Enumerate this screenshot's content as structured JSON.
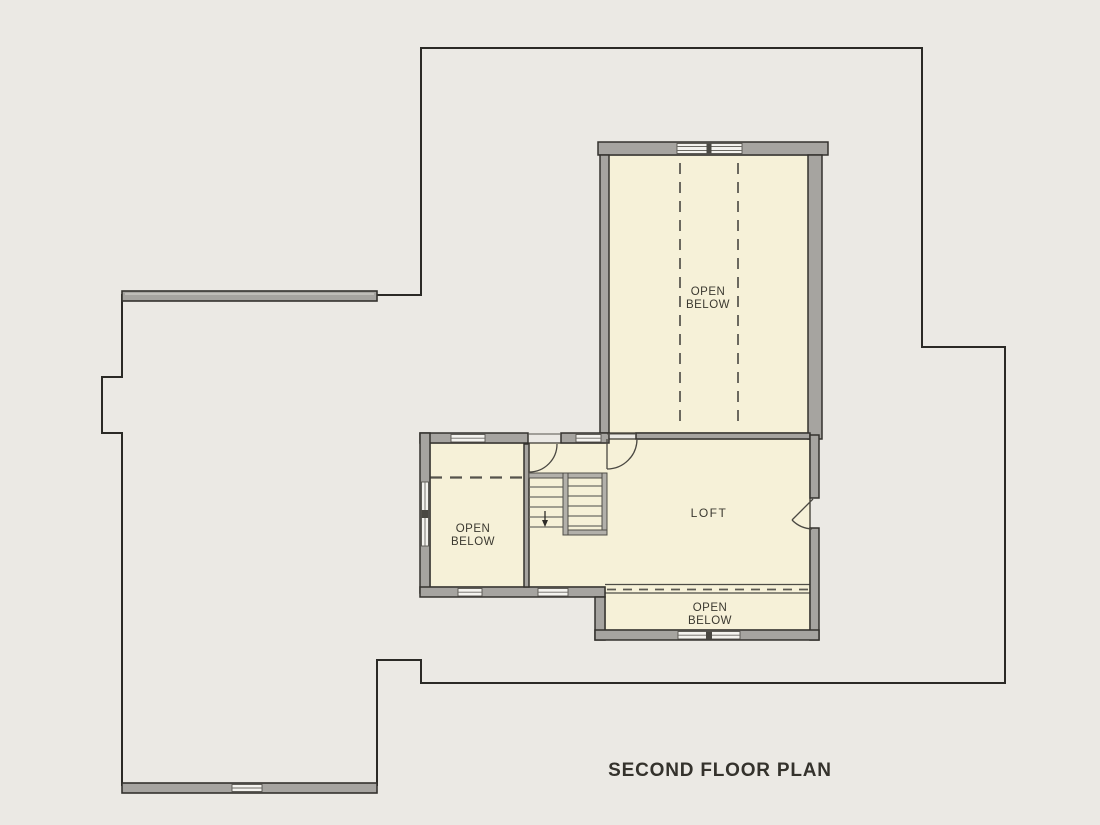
{
  "title": "SECOND FLOOR PLAN",
  "labels": {
    "upper_open_below": {
      "line1": "OPEN",
      "line2": "BELOW"
    },
    "left_open_below": {
      "line1": "OPEN",
      "line2": "BELOW"
    },
    "lower_open_below": {
      "line1": "OPEN",
      "line2": "BELOW"
    },
    "loft": "LOFT"
  },
  "colors": {
    "background": "#ebe9e4",
    "room_fill": "#f6f1d8",
    "wall_fill": "#a6a4a0",
    "wall_outline": "#34322e",
    "footprint_line": "#2b2a26",
    "window_fill": "#f4f3ef",
    "stair_rail_fill": "#b2b0aa",
    "dash_line": "#5c5a52",
    "text": "#3b3930"
  }
}
